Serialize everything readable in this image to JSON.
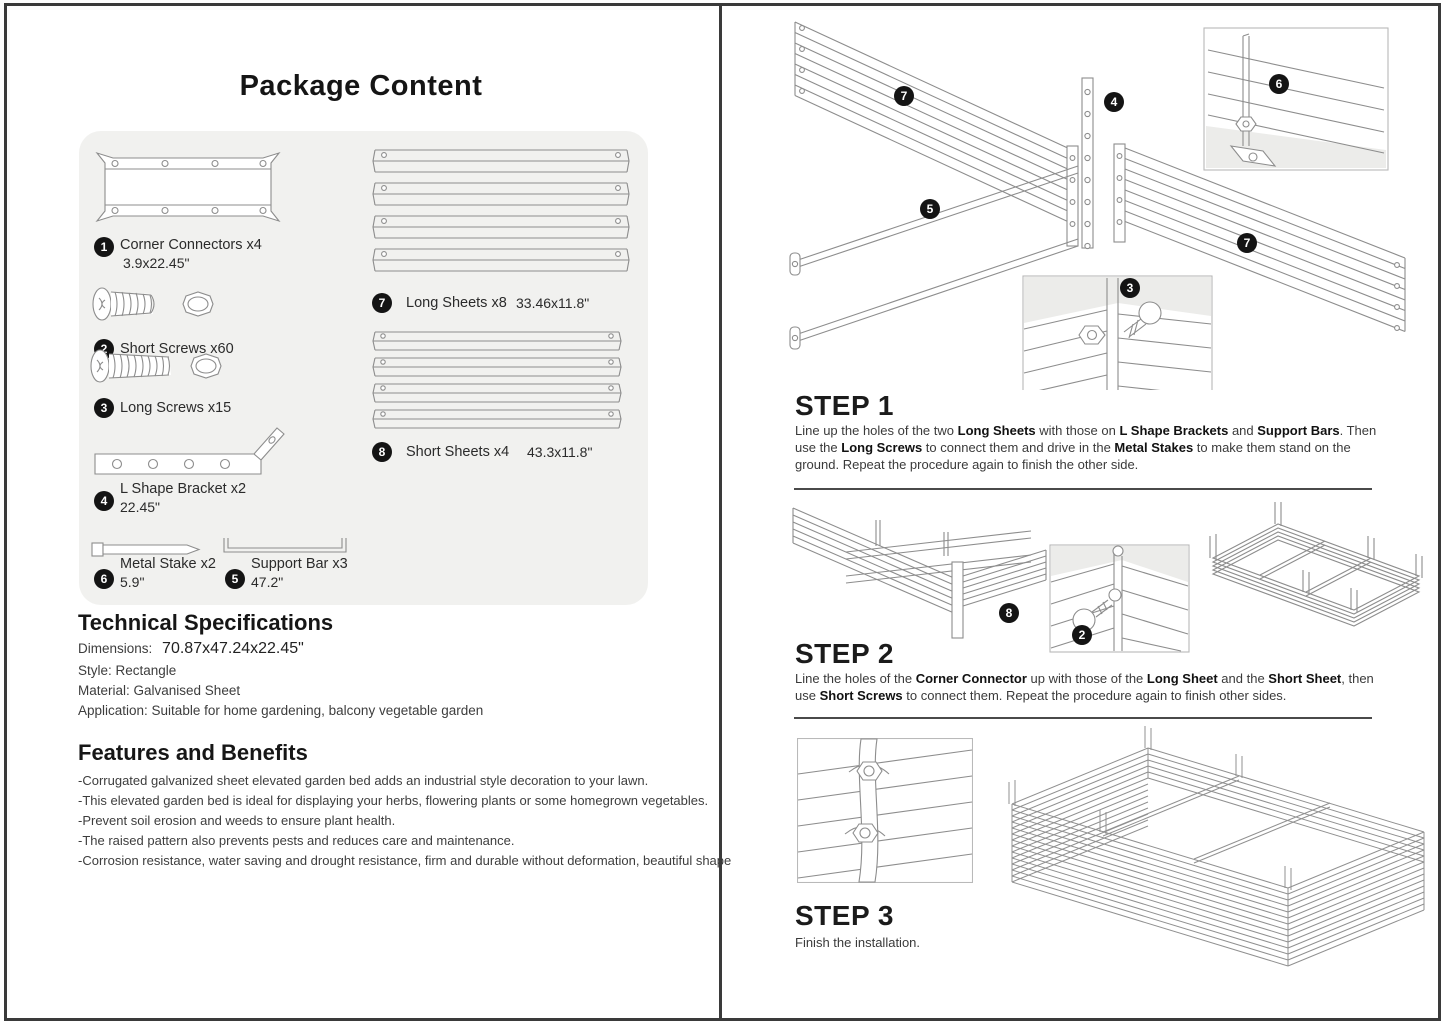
{
  "package": {
    "title": "Package Content",
    "parts": [
      {
        "num": "1",
        "label": "Corner Connectors x4",
        "dims": "3.9x22.45\""
      },
      {
        "num": "2",
        "label": "Short Screws x60",
        "dims": ""
      },
      {
        "num": "3",
        "label": "Long Screws x15",
        "dims": ""
      },
      {
        "num": "4",
        "label": "L Shape Bracket x2",
        "dims": "22.45\""
      },
      {
        "num": "6",
        "label": "Metal Stake x2",
        "dims": "5.9\""
      },
      {
        "num": "5",
        "label": "Support Bar x3",
        "dims": "47.2\""
      },
      {
        "num": "7",
        "label": "Long Sheets x8",
        "dims": "33.46x11.8\""
      },
      {
        "num": "8",
        "label": "Short Sheets x4",
        "dims": "43.3x11.8\""
      }
    ]
  },
  "tech_specs": {
    "title": "Technical Specifications",
    "dimensions_label": "Dimensions:",
    "dimensions_value": "70.87x47.24x22.45\"",
    "style_line": "Style: Rectangle",
    "material_line": "Material: Galvanised Sheet",
    "application_line": "Application: Suitable for home gardening, balcony vegetable garden"
  },
  "features": {
    "title": "Features and Benefits",
    "items": [
      "-Corrugated galvanized sheet elevated garden bed adds an industrial style decoration to your lawn.",
      "-This elevated garden bed is ideal for displaying your herbs, flowering plants or some homegrown vegetables.",
      "-Prevent soil erosion and weeds to ensure plant health.",
      "-The raised pattern also prevents pests and reduces care and maintenance.",
      "-Corrosion resistance, water saving and drought resistance, firm and durable without deformation, beautiful shape"
    ]
  },
  "steps": {
    "step1": {
      "title": "STEP 1",
      "callouts": [
        "7",
        "4",
        "6",
        "5",
        "3",
        "7"
      ],
      "segments": [
        "Line up the holes of the two ",
        "Long Sheets",
        " with those on ",
        "L Shape Brackets",
        " and ",
        "Support Bars",
        ". Then use the ",
        "Long Screws",
        " to connect them and drive in the ",
        "Metal Stakes",
        " to make them stand on the ground. Repeat the procedure again to finish the other side."
      ]
    },
    "step2": {
      "title": "STEP 2",
      "callouts": [
        "8",
        "2"
      ],
      "segments": [
        "Line the holes of the ",
        "Corner Connector",
        " up with those of the ",
        "Long Sheet",
        " and the ",
        "Short Sheet",
        ", then use ",
        "Short Screws",
        " to connect them. Repeat the procedure again to finish other sides."
      ]
    },
    "step3": {
      "title": "STEP 3",
      "text": "Finish the installation."
    }
  },
  "colors": {
    "line_art": "#8d8d8d",
    "badge_bg": "#141414",
    "panel_bg": "#f1f1ef"
  }
}
